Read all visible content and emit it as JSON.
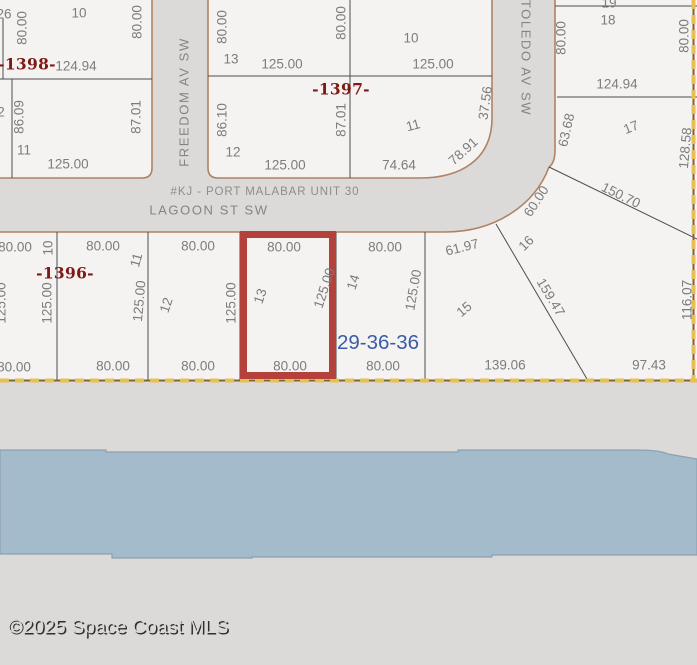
{
  "map": {
    "unit_title": "#KJ - PORT MALABAR UNIT 30",
    "section_township_range": "29-36-36",
    "streets": [
      "FREEDOM AV SW",
      "LAGOON ST SW",
      "TOLEDO AV SW"
    ],
    "plat_block_numbers": [
      "-1398-",
      "-1397-",
      "-1396-"
    ],
    "highlighted_lot": "13",
    "labels": [
      {
        "t": "26",
        "x": 4,
        "y": 14,
        "r": 0,
        "c": "dim"
      },
      {
        "t": "10",
        "x": 79,
        "y": 13,
        "r": 0,
        "c": "lot"
      },
      {
        "t": "80.00",
        "x": 22,
        "y": 28,
        "r": -90,
        "c": "dim"
      },
      {
        "t": "80.00",
        "x": 137,
        "y": 22,
        "r": -90,
        "c": "dim"
      },
      {
        "t": "-1398-",
        "x": 27,
        "y": 64,
        "r": 0,
        "c": "plat"
      },
      {
        "t": "124.94",
        "x": 76,
        "y": 66,
        "r": 0,
        "c": "dim"
      },
      {
        "t": "2",
        "x": 1,
        "y": 112,
        "r": 0,
        "c": "dim"
      },
      {
        "t": "86.09",
        "x": 19,
        "y": 117,
        "r": -90,
        "c": "dim"
      },
      {
        "t": "87.01",
        "x": 136,
        "y": 117,
        "r": -90,
        "c": "dim"
      },
      {
        "t": "11",
        "x": 24,
        "y": 150,
        "r": 0,
        "c": "lot"
      },
      {
        "t": "125.00",
        "x": 68,
        "y": 164,
        "r": 0,
        "c": "dim"
      },
      {
        "t": "80.00",
        "x": 222,
        "y": 27,
        "r": -90,
        "c": "dim"
      },
      {
        "t": "13",
        "x": 231,
        "y": 59,
        "r": 0,
        "c": "lot"
      },
      {
        "t": "125.00",
        "x": 282,
        "y": 64,
        "r": 0,
        "c": "dim"
      },
      {
        "t": "80.00",
        "x": 341,
        "y": 23,
        "r": -90,
        "c": "dim"
      },
      {
        "t": "10",
        "x": 411,
        "y": 38,
        "r": 0,
        "c": "lot"
      },
      {
        "t": "125.00",
        "x": 433,
        "y": 64,
        "r": 0,
        "c": "dim"
      },
      {
        "t": "-1397-",
        "x": 341,
        "y": 89,
        "r": 0,
        "c": "plat"
      },
      {
        "t": "86.10",
        "x": 222,
        "y": 120,
        "r": -90,
        "c": "dim"
      },
      {
        "t": "12",
        "x": 233,
        "y": 152,
        "r": 0,
        "c": "lot"
      },
      {
        "t": "125.00",
        "x": 285,
        "y": 165,
        "r": 0,
        "c": "dim"
      },
      {
        "t": "87.01",
        "x": 341,
        "y": 120,
        "r": -90,
        "c": "dim"
      },
      {
        "t": "11",
        "x": 413,
        "y": 125,
        "r": -15,
        "c": "lot"
      },
      {
        "t": "74.64",
        "x": 399,
        "y": 165,
        "r": 0,
        "c": "dim"
      },
      {
        "t": "37.56",
        "x": 485,
        "y": 103,
        "r": -82,
        "c": "dim"
      },
      {
        "t": "78.91",
        "x": 463,
        "y": 151,
        "r": -42,
        "c": "dim"
      },
      {
        "t": "19",
        "x": 609,
        "y": 3,
        "r": 0,
        "c": "lot"
      },
      {
        "t": "18",
        "x": 608,
        "y": 20,
        "r": 0,
        "c": "lot"
      },
      {
        "t": "80.00",
        "x": 561,
        "y": 38,
        "r": -90,
        "c": "dim"
      },
      {
        "t": "80.00",
        "x": 684,
        "y": 36,
        "r": -90,
        "c": "dim"
      },
      {
        "t": "124.94",
        "x": 617,
        "y": 84,
        "r": 0,
        "c": "dim"
      },
      {
        "t": "63.68",
        "x": 566,
        "y": 130,
        "r": -77,
        "c": "dim"
      },
      {
        "t": "17",
        "x": 631,
        "y": 127,
        "r": -22,
        "c": "lot"
      },
      {
        "t": "128.58",
        "x": 685,
        "y": 148,
        "r": -85,
        "c": "dim"
      },
      {
        "t": "80.00",
        "x": 15,
        "y": 247,
        "r": 0,
        "c": "dim"
      },
      {
        "t": "10",
        "x": 48,
        "y": 248,
        "r": -90,
        "c": "lot"
      },
      {
        "t": "-1396-",
        "x": 65,
        "y": 273,
        "r": 0,
        "c": "plat"
      },
      {
        "t": "125.00",
        "x": 1,
        "y": 303,
        "r": -90,
        "c": "dim"
      },
      {
        "t": "125.00",
        "x": 47,
        "y": 303,
        "r": -90,
        "c": "dim"
      },
      {
        "t": "80.00",
        "x": 14,
        "y": 367,
        "r": 0,
        "c": "dim"
      },
      {
        "t": "80.00",
        "x": 103,
        "y": 246,
        "r": 0,
        "c": "dim"
      },
      {
        "t": "11",
        "x": 136,
        "y": 260,
        "r": -75,
        "c": "lot"
      },
      {
        "t": "125.00",
        "x": 139,
        "y": 301,
        "r": -85,
        "c": "dim"
      },
      {
        "t": "80.00",
        "x": 113,
        "y": 366,
        "r": 0,
        "c": "dim"
      },
      {
        "t": "80.00",
        "x": 198,
        "y": 246,
        "r": 0,
        "c": "dim"
      },
      {
        "t": "12",
        "x": 166,
        "y": 305,
        "r": -72,
        "c": "lot"
      },
      {
        "t": "125.00",
        "x": 231,
        "y": 303,
        "r": -90,
        "c": "dim"
      },
      {
        "t": "80.00",
        "x": 198,
        "y": 366,
        "r": 0,
        "c": "dim"
      },
      {
        "t": "80.00",
        "x": 284,
        "y": 247,
        "r": 0,
        "c": "dim"
      },
      {
        "t": "13",
        "x": 260,
        "y": 296,
        "r": -72,
        "c": "lot"
      },
      {
        "t": "125.00",
        "x": 324,
        "y": 288,
        "r": -72,
        "c": "dim"
      },
      {
        "t": "80.00",
        "x": 290,
        "y": 366,
        "r": 0,
        "c": "dim"
      },
      {
        "t": "80.00",
        "x": 385,
        "y": 247,
        "r": 0,
        "c": "dim"
      },
      {
        "t": "14",
        "x": 353,
        "y": 282,
        "r": -72,
        "c": "lot"
      },
      {
        "t": "125.00",
        "x": 413,
        "y": 290,
        "r": -80,
        "c": "dim"
      },
      {
        "t": "29-36-36",
        "x": 378,
        "y": 342,
        "r": 0,
        "c": "section"
      },
      {
        "t": "80.00",
        "x": 383,
        "y": 366,
        "r": 0,
        "c": "dim"
      },
      {
        "t": "61.97",
        "x": 462,
        "y": 247,
        "r": -14,
        "c": "dim"
      },
      {
        "t": "15",
        "x": 464,
        "y": 309,
        "r": -40,
        "c": "lot"
      },
      {
        "t": "139.06",
        "x": 505,
        "y": 365,
        "r": 0,
        "c": "dim"
      },
      {
        "t": "16",
        "x": 526,
        "y": 243,
        "r": -45,
        "c": "lot"
      },
      {
        "t": "60.00",
        "x": 536,
        "y": 201,
        "r": -57,
        "c": "dim"
      },
      {
        "t": "150.70",
        "x": 621,
        "y": 195,
        "r": 26,
        "c": "dim"
      },
      {
        "t": "159.47",
        "x": 551,
        "y": 297,
        "r": 59,
        "c": "dim"
      },
      {
        "t": "97.43",
        "x": 649,
        "y": 365,
        "r": 0,
        "c": "dim"
      },
      {
        "t": "116.07",
        "x": 687,
        "y": 300,
        "r": -90,
        "c": "dim"
      },
      {
        "t": "FREEDOM AV SW",
        "x": 184,
        "y": 102,
        "r": -90,
        "c": "street"
      },
      {
        "t": "TOLEDO AV SW",
        "x": 526,
        "y": 58,
        "r": 90,
        "c": "street"
      },
      {
        "t": "LAGOON ST SW",
        "x": 209,
        "y": 210,
        "r": 0,
        "c": "street"
      },
      {
        "t": "#KJ - PORT MALABAR UNIT 30",
        "x": 265,
        "y": 191,
        "r": 0,
        "c": "unit"
      }
    ]
  },
  "watermark": "©2025 Space Coast MLS",
  "colors": {
    "background_street_gray": "#dbdad8",
    "parcel_fill": "#f4f3f1",
    "street_edge_tan": "#b08263",
    "lot_line": "#4e4e4e",
    "dimension_text": "#7c7c7c",
    "plat_number_red": "#7e1a16",
    "section_blue": "#3b5ba5",
    "highlight_red": "#b5423a",
    "boundary_gold": "#e5c054",
    "water_blue": "#a4bbcb"
  }
}
